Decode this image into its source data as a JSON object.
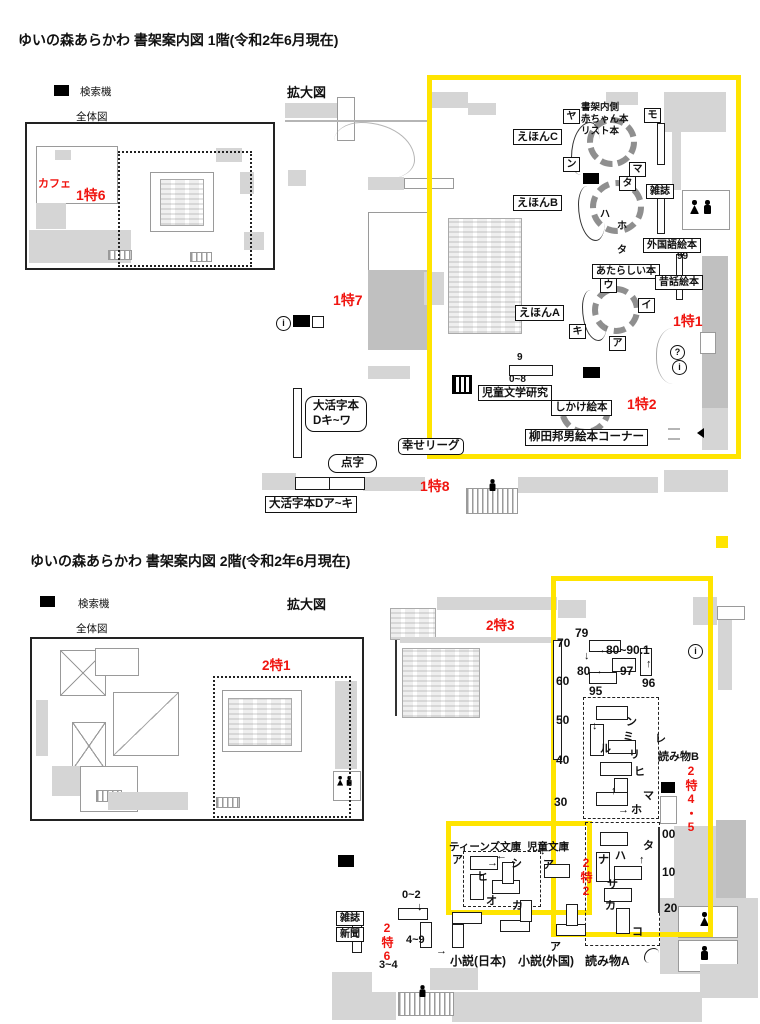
{
  "colors": {
    "red": "#f01510",
    "yellow": "#ffe400"
  },
  "glyphs": {
    "down": "↓",
    "up": "↑",
    "right": "→",
    "left": "←"
  },
  "floor1": {
    "title": "ゆいの森あらかわ 書架案内図 1階(令和2年6月現在)",
    "legend": {
      "search": "検索機",
      "overview": "全体図",
      "enlarged": "拡大図"
    },
    "red": {
      "cafe": "カフェ",
      "t6": "1特6",
      "t7": "1特7",
      "t1": "1特1",
      "t2": "1特2",
      "t8": "1特8"
    },
    "labels": {
      "ehonC": "えほんC",
      "ehonB": "えほんB",
      "ehonA": "えほんA",
      "inner_note": "書架内側\n赤ちゃん本\nリスト本",
      "magazine": "雑誌",
      "foreign": "外国語絵本",
      "new_books": "あたらしい本",
      "folk": "昔話絵本",
      "child_lit": "児童文学研究",
      "popup": "しかけ絵本",
      "yanagida": "柳田邦男絵本コーナー",
      "large1": "大活字本\nDキ~ワ",
      "happy": "幸せリーグ",
      "braille": "点字",
      "large2": "大活字本Dア~キ"
    },
    "kana_boxed": [
      "ヤ",
      "モ",
      "ン",
      "マ",
      "タ",
      "ウ",
      "イ",
      "キ",
      "ア"
    ],
    "kana_plain": [
      "ハ",
      "ホ",
      "タ"
    ],
    "numbers": {
      "n9": "9",
      "n08": "0~8",
      "n99": "99"
    },
    "circles": {
      "q": "?",
      "i": "i",
      "i2": "i"
    }
  },
  "floor2": {
    "title": "ゆいの森あらかわ 書架案内図 2階(令和2年6月現在)",
    "legend": {
      "search": "検索機",
      "overview": "全体図",
      "enlarged": "拡大図"
    },
    "red": {
      "t3": "2特3",
      "t1": "2特1",
      "t45": "2特4・5",
      "t2": "2特2",
      "t6": "2特6"
    },
    "labels": {
      "yomimonoB": "読み物B",
      "yomimonoA": "読み物A",
      "teens": "ティーンズ文庫",
      "jidobunko": "児童文庫",
      "magazine": "雑誌",
      "newspaper": "新聞",
      "novel_jp": "小説(日本)",
      "novel_foreign": "小説(外国)"
    },
    "numbers": {
      "n79": "79",
      "n70": "70",
      "n8090": "80~90.1",
      "n80": "80",
      "n60": "60",
      "n97": "97",
      "n96": "96",
      "n95": "95",
      "n50": "50",
      "n40": "40",
      "n30": "30",
      "n00": "00",
      "n10": "10",
      "n20": "20",
      "r02": "0~2",
      "r49": "4~9",
      "r34": "3~4"
    },
    "kana": [
      "ン",
      "ミ",
      "ル",
      "リ",
      "ヒ",
      "マ",
      "ホ",
      "レ",
      "ナ",
      "ハ",
      "サ",
      "カ",
      "タ",
      "コ",
      "ア",
      "シ",
      "ヒ",
      "オ",
      "カ",
      "ア",
      "ア"
    ],
    "circles": {
      "i": "i"
    }
  }
}
